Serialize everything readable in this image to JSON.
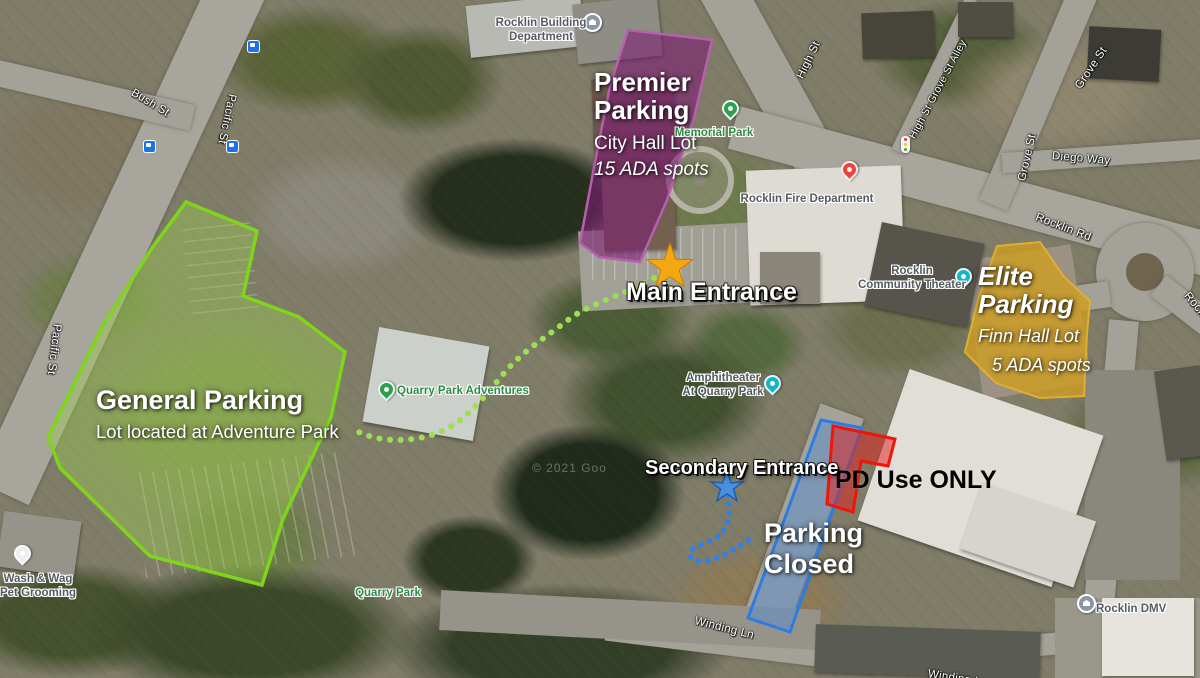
{
  "map": {
    "attribution": "© 2021 Goo",
    "pois": {
      "building_dept": "Rocklin Building\nDepartment",
      "memorial_park": "Memorial Park",
      "fire_dept": "Rocklin Fire Department",
      "community_theater": "Rocklin\nCommunity Theater",
      "amphitheater": "Amphitheater\nAt Quarry Park",
      "quarry_park_adventures": "Quarry Park Adventures",
      "quarry_park": "Quarry Park",
      "wash_wag": "Wash & Wag\nPet Grooming",
      "dmv": "Rocklin DMV"
    },
    "streets": {
      "bush": "Bush St",
      "pacific_north": "Pacific St",
      "pacific_south": "Pacific St",
      "high": "High St",
      "high_grove_alley": "High St Grove St Alley",
      "grove_north": "Grove St",
      "grove_south": "Grove St",
      "diego": "Diego Way",
      "rocklin_rd": "Rocklin Rd",
      "rocklin_rd_east": "Rocklin Rd",
      "winding_ln": "Winding Ln",
      "winding_ln_south": "Winding Ln"
    },
    "colors": {
      "park_label": "#2e8b44",
      "poi_label": "#565b61",
      "street_label": "#ffffff",
      "bus_stop": "#1a73e8"
    },
    "icons": {
      "bus_stop": "bus-stop-icon",
      "traffic_light": "traffic-light-icon",
      "park_pin": "park-pin-icon",
      "fire_station_pin": "fire-station-pin-icon",
      "theater_pin": "theater-pin-icon",
      "civic_building_pin": "civic-building-pin-icon",
      "store_pin": "store-pin-icon"
    }
  },
  "annotations": {
    "premier": {
      "title": "Premier\nParking",
      "subtitle": "City Hall Lot",
      "detail": "15 ADA spots",
      "fill": "rgba(125,28,115,0.6)",
      "stroke": "#b561ae"
    },
    "general": {
      "title": "General Parking",
      "subtitle": "Lot located at Adventure Park",
      "fill": "rgba(158,206,80,0.42)",
      "stroke": "#7fd41c"
    },
    "elite": {
      "title": "Elite\nParking",
      "subtitle": "Finn Hall Lot",
      "detail": "5 ADA spots",
      "fill": "rgba(207,157,31,0.8)",
      "stroke": "#ddb032"
    },
    "parking_closed": {
      "title": "Parking\nClosed",
      "fill": "rgba(88,140,205,0.5)",
      "stroke": "#2d7de0"
    },
    "pd_only": {
      "title": "PD Use ONLY",
      "fill": "rgba(228,30,25,0.5)",
      "stroke": "#ef1509"
    },
    "main_entrance": {
      "label": "Main Entrance",
      "star_fill": "#f3a812",
      "star_stroke": "#c77d00",
      "path_color": "#9ede52"
    },
    "secondary_entrance": {
      "label": "Secondary Entrance",
      "star_fill": "#4a8fdd",
      "star_stroke": "#1d5fae",
      "path_color": "#2f80e8"
    }
  }
}
